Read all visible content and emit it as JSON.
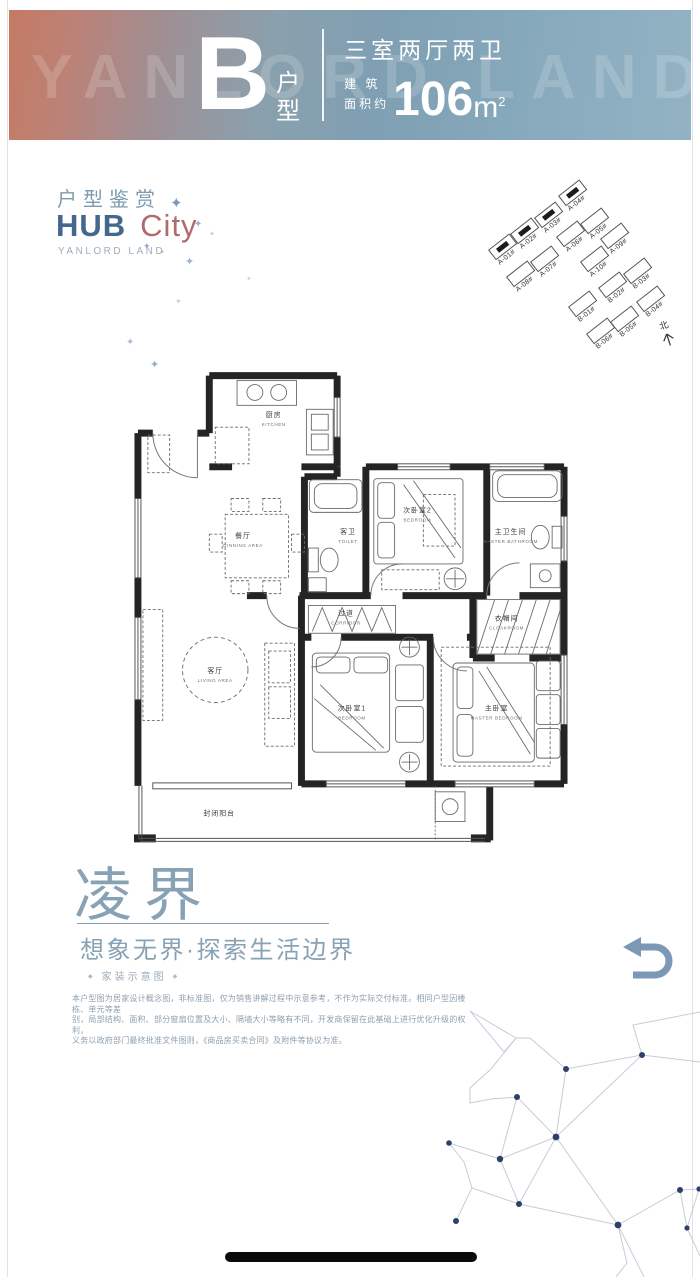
{
  "banner": {
    "watermark": "YANLORD LAND",
    "type_letter": "B",
    "type_suffix": "户型",
    "layout": "三室两厅两卫",
    "area_label_top": "建 筑",
    "area_label_bottom": "面积约",
    "area_value": "106",
    "area_unit": "m",
    "area_power": "2"
  },
  "header": {
    "subtitle": "户型鉴赏",
    "brand_primary": "HUB",
    "brand_secondary": "City",
    "brand_caption": "YANLORD LAND"
  },
  "decor": {
    "sparkle_glyph": "✦",
    "sparkles": [
      {
        "x": 170,
        "y": 196,
        "s": 15,
        "o": 0.95
      },
      {
        "x": 194,
        "y": 220,
        "s": 10,
        "o": 0.75
      },
      {
        "x": 143,
        "y": 242,
        "s": 9,
        "o": 0.8
      },
      {
        "x": 185,
        "y": 257,
        "s": 11,
        "o": 0.7
      },
      {
        "x": 209,
        "y": 231,
        "s": 7,
        "o": 0.5
      },
      {
        "x": 126,
        "y": 338,
        "s": 10,
        "o": 0.6
      },
      {
        "x": 175,
        "y": 298,
        "s": 8,
        "o": 0.45
      },
      {
        "x": 150,
        "y": 360,
        "s": 11,
        "o": 0.75
      },
      {
        "x": 246,
        "y": 276,
        "s": 7,
        "o": 0.4
      },
      {
        "x": 160,
        "y": 250,
        "s": 6,
        "o": 0.5
      }
    ]
  },
  "siteplan": {
    "north_label": "北",
    "buildings": [
      {
        "label": "A-01#",
        "x": 20,
        "y": 68,
        "filled": true
      },
      {
        "label": "A-02#",
        "x": 42,
        "y": 52,
        "filled": true
      },
      {
        "label": "A-03#",
        "x": 66,
        "y": 36,
        "filled": true
      },
      {
        "label": "A-04#",
        "x": 90,
        "y": 14,
        "filled": true
      },
      {
        "label": "A-05#",
        "x": 112,
        "y": 42,
        "filled": false
      },
      {
        "label": "A-06#",
        "x": 88,
        "y": 55,
        "filled": false
      },
      {
        "label": "A-07#",
        "x": 62,
        "y": 80,
        "filled": false
      },
      {
        "label": "A-08#",
        "x": 38,
        "y": 95,
        "filled": false
      },
      {
        "label": "A-09#",
        "x": 132,
        "y": 57,
        "filled": false
      },
      {
        "label": "A-10#",
        "x": 112,
        "y": 80,
        "filled": false
      },
      {
        "label": "B-01#",
        "x": 100,
        "y": 125,
        "filled": false
      },
      {
        "label": "B-02#",
        "x": 130,
        "y": 106,
        "filled": false
      },
      {
        "label": "B-03#",
        "x": 155,
        "y": 92,
        "filled": false
      },
      {
        "label": "B-04#",
        "x": 168,
        "y": 120,
        "filled": false
      },
      {
        "label": "B-05#",
        "x": 142,
        "y": 140,
        "filled": false
      },
      {
        "label": "B-06#",
        "x": 118,
        "y": 152,
        "filled": false
      }
    ]
  },
  "floorplan": {
    "rooms": [
      {
        "cn": "厨房",
        "en": "KITCHEN",
        "x": 137,
        "y": 50
      },
      {
        "cn": "餐厅",
        "en": "DINNING AREA",
        "x": 106,
        "y": 172
      },
      {
        "cn": "客卫",
        "en": "TOILET",
        "x": 212,
        "y": 168
      },
      {
        "cn": "次卧室2",
        "en": "BEDROOM",
        "x": 282,
        "y": 146
      },
      {
        "cn": "主卫生间",
        "en": "MASTER BATHROOM",
        "x": 376,
        "y": 168
      },
      {
        "cn": "过道",
        "en": "CORRIDOR",
        "x": 210,
        "y": 250
      },
      {
        "cn": "衣帽间",
        "en": "CLOAKROOM",
        "x": 372,
        "y": 255
      },
      {
        "cn": "客厅",
        "en": "LIVING AREA",
        "x": 78,
        "y": 308
      },
      {
        "cn": "次卧室1",
        "en": "BEDROOM",
        "x": 216,
        "y": 346
      },
      {
        "cn": "主卧室",
        "en": "MASTER BEDROOM",
        "x": 362,
        "y": 346
      },
      {
        "cn": "封闭阳台",
        "en": "",
        "x": 82,
        "y": 452
      }
    ]
  },
  "footer": {
    "title": "凌界",
    "tagline": "想象无界·探索生活边界",
    "note": "家装示意图",
    "diamond": "◆",
    "disclaimer": [
      "本户型图为居家设计概念图，非标准图，仅为销售讲解过程中示意参考，不作为实际交付标准。相同户型因楼栋、单元等差",
      "别，局部结构、面积、部分窗扇位置及大小、隔墙大小等略有不同，开发商保留在此基础上进行优化升级的权利，",
      "义务以政府部门最终批准文件图则，《商品房买卖合同》及附件等协议为准。"
    ]
  }
}
